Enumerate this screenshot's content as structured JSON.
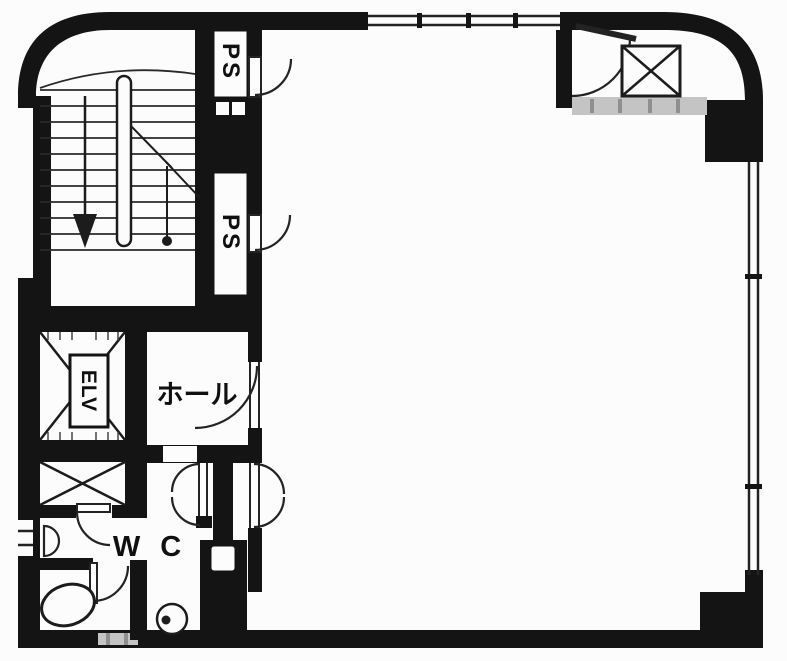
{
  "plan": {
    "type": "building-floor-plan",
    "labels": {
      "ps_top": "PS",
      "ps_bottom": "PS",
      "elevator": "ELV",
      "hall": "ホール",
      "toilet": "W C"
    },
    "features": [
      "staircase-with-down-arrow",
      "elevator-shaft-x",
      "duct-shaft-x-below-elevator",
      "duct-shaft-x-top-right-room",
      "double-swing-doors",
      "windows-top-and-right",
      "wc-fixtures"
    ],
    "colors": {
      "wall": "#141414",
      "line": "#232323",
      "background": "#fcfcfc",
      "light_partition": "#c4c4c4",
      "partition_hatch": "#8f8f8f"
    }
  }
}
